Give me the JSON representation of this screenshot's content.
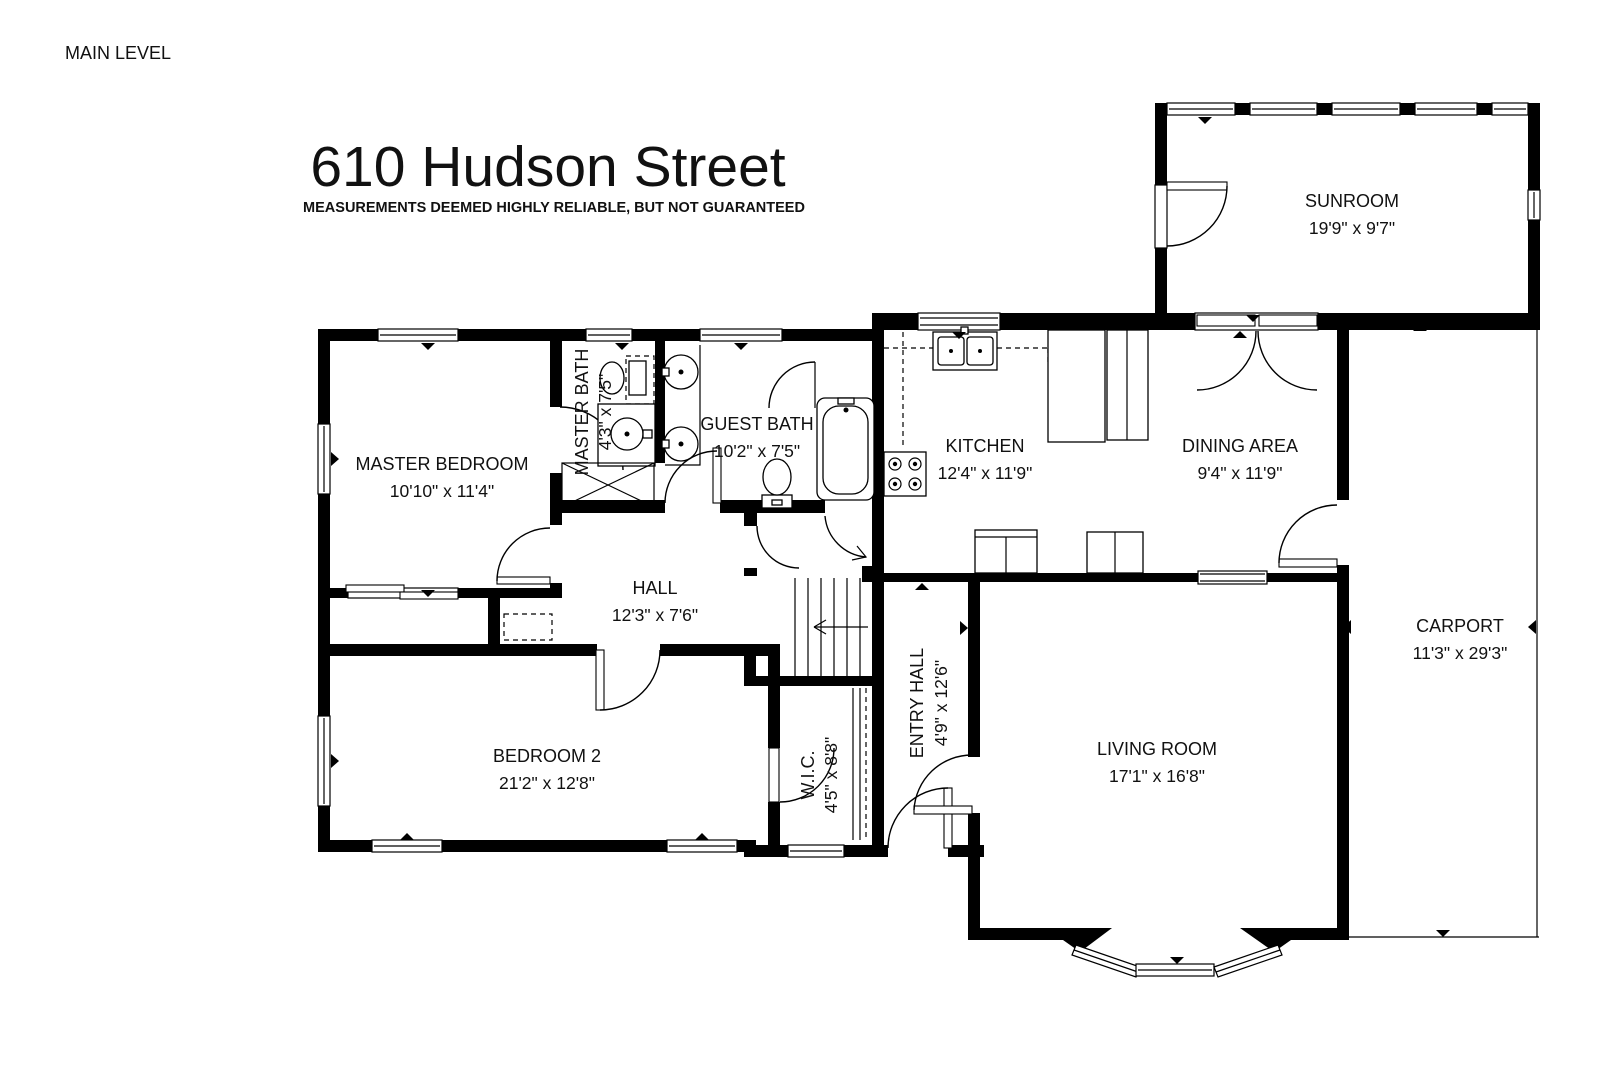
{
  "page": {
    "level_label": "MAIN LEVEL",
    "title": "610 Hudson Street",
    "disclaimer": "MEASUREMENTS DEEMED HIGHLY RELIABLE, BUT NOT GUARANTEED"
  },
  "rooms": {
    "sunroom": {
      "name": "SUNROOM",
      "dims": "19'9\" x 9'7\""
    },
    "master_bedroom": {
      "name": "MASTER BEDROOM",
      "dims": "10'10\" x 11'4\""
    },
    "master_bath": {
      "name": "MASTER BATH",
      "dims": "4'3\" x 7'5\""
    },
    "guest_bath": {
      "name": "GUEST BATH",
      "dims": "10'2\" x 7'5\""
    },
    "kitchen": {
      "name": "KITCHEN",
      "dims": "12'4\" x 11'9\""
    },
    "dining_area": {
      "name": "DINING AREA",
      "dims": "9'4\" x 11'9\""
    },
    "carport": {
      "name": "CARPORT",
      "dims": "11'3\" x 29'3\""
    },
    "hall": {
      "name": "HALL",
      "dims": "12'3\" x 7'6\""
    },
    "bedroom_2": {
      "name": "BEDROOM 2",
      "dims": "21'2\" x 12'8\""
    },
    "wic": {
      "name": "W.I.C.",
      "dims": "4'5\" x 8'8\""
    },
    "entry_hall": {
      "name": "ENTRY HALL",
      "dims": "4'9\" x 12'6\""
    },
    "living_room": {
      "name": "LIVING ROOM",
      "dims": "17'1\" x 16'8\""
    }
  }
}
